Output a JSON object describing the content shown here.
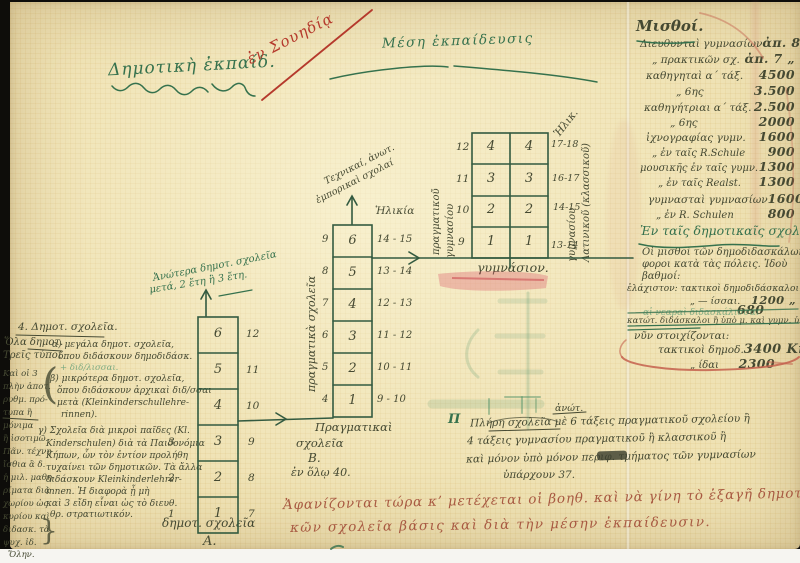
{
  "headers": {
    "primary": "Δημοτικὴ ἐκπαίδ.",
    "annotation_red": "ἐν Σουηδίᾳ",
    "secondary": "Μέση ἐκπαίδευσις"
  },
  "salary_list": {
    "title": "Μισθοί.",
    "rows": [
      {
        "label": "Διευθυνταὶ γυμνασίων",
        "value": "ἀπ. 8 χιλ. Κρ."
      },
      {
        "label": "„  πρακτικῶν σχ.",
        "value": "ἀπ. 7  „"
      },
      {
        "label": "καθηγηταὶ α΄ τάξ.",
        "value": "4500"
      },
      {
        "label": "„  6ης",
        "value": "3.500"
      },
      {
        "label": "καθηγήτριαι α΄ τάξ.",
        "value": "2.500"
      },
      {
        "label": "„  6ης",
        "value": "2000"
      },
      {
        "label": "ἰχνογραφίας γυμν.",
        "value": "1600"
      },
      {
        "label": "„  ἐν ταῖς R.Schule",
        "value": "900"
      },
      {
        "label": "μουσικῆς ἐν ταῖς γυμν.",
        "value": "1300"
      },
      {
        "label": "„  ἐν ταῖς Realst.",
        "value": "1300"
      },
      {
        "label": "γυμνασταὶ γυμνασίων",
        "value": "1600"
      },
      {
        "label": "„  ἐν R. Schulen",
        "value": "800"
      }
    ],
    "primary_section": {
      "title": "Ἐν ταῖς δημοτικαῖς σχολαῖς",
      "notes": [
        "Οἱ μισθοὶ τῶν δημοδιδασκάλων διά-",
        "φοροι κατὰ τὰς πόλεις. Ἰδοὺ",
        "βαθμοί:"
      ],
      "row_min": {
        "label": "ἐλάχιστον: τακτικοὶ δημοδιδάσκαλοι",
        "value": "1250 Kr."
      },
      "row_min2": {
        "label": "„  — ίσσαι.",
        "value": "1200 „"
      },
      "row_680": {
        "label": "αἱ νεαραὶ διδασκάλισσαι",
        "value": "680"
      },
      "row_struck": "κατώτ. διδάσκαλοι ἢ ὑπὸ μ. καὶ γυμν. ὑπηρ.",
      "row_now": "νῦν στοιχίζονται:",
      "row_3400": {
        "label": "τακτικοὶ δημοδ.",
        "value": "3400 Kr."
      },
      "row_2300": {
        "label": "„  ίδαι",
        "value": "2300"
      }
    }
  },
  "primary_ladder": {
    "note_line1": "Ἀνώτερα δημοτ. σχολεῖα",
    "note_line2": "μετά, 2 ἔτη ἢ 3 ἔτη.",
    "cells": [
      "6",
      "5",
      "4",
      "3",
      "2",
      "1"
    ],
    "right_numbers": [
      "12",
      "11",
      "10",
      "9",
      "8",
      "7"
    ],
    "left_numbers": [
      "3",
      "2",
      "1"
    ],
    "caption": "δημοτ. σχολεῖα",
    "caption2": "Α."
  },
  "real_ladder": {
    "top_note1": "Τεχνικαί, ἀνωτ.",
    "top_note2": "ἐμπορικαὶ σχολαί",
    "age_header": "Ἡλικία",
    "cells": [
      "6",
      "5",
      "4",
      "3",
      "2",
      "1"
    ],
    "left_numbers": [
      "9",
      "8",
      "7",
      "6",
      "5",
      "4"
    ],
    "ages": [
      "14 - 15",
      "13 - 14",
      "12 - 13",
      "11 - 12",
      "10 - 11",
      "9 - 10"
    ],
    "side_label": "πραγματικὰ σχολεῖα",
    "caption1": "Πραγματικαὶ",
    "caption2": "σχολεῖα",
    "caption3": "Β.",
    "caption4": "ἐν ὅλῳ 40."
  },
  "gymnasium": {
    "age_header": "Ἡλικ.",
    "row_labels": [
      "12",
      "11",
      "10",
      "9"
    ],
    "cells_left": [
      "4",
      "3",
      "2",
      "1"
    ],
    "cells_right": [
      "4",
      "3",
      "2",
      "1"
    ],
    "ages": [
      "17-18",
      "16-17",
      "14-15",
      "13-14"
    ],
    "left_label1": "πραγματικοῦ",
    "left_label2": "γυμνασίου",
    "right_label1": "γυμνασίου",
    "right_label2": "Λατινικοῦ (κλασσικοῦ)",
    "caption": "γυμνάσιον."
  },
  "full_note": {
    "mark": "Π",
    "super": "ἀνώτ.",
    "line1": "Πλήρη σχολεῖα μὲ 6 τάξεις πραγματικοῦ σχολείου ἢ",
    "line2": "4 τάξεις γυμνασίου πραγματικοῦ ἢ κλασσικοῦ ἢ",
    "line3": "καὶ μόνον ὑπὸ μόνον περιφ. τμήματος τῶν γυμνασίων",
    "line4": "ὑπάρχουν 37."
  },
  "bottom_note": {
    "line1": "Ἀφανίζονται τώρα κ’ μετέχεται οἱ βοηθ. καὶ νὰ γίνη τὸ ἑξαγῆ δημοτι —",
    "line2": "κῶν σχολεῖα βάσις καὶ διὰ τὴν μέσην ἐκπαίδευσιν."
  },
  "margin": {
    "heading": "4. Δημοτ. σχολεῖα.",
    "sub1": "Ὅλα δημοτ.",
    "sub2": "Τρεῖς τύποι",
    "item_a": [
      "α) μεγάλα δημοτ. σχολεῖα,",
      "ὅπου διδάσκουν δημοδιδάσκ.",
      "+ διδ/λισσαι."
    ],
    "item_b": [
      "β) μικρότερα δημοτ. σχολεῖα,",
      "ὅπου διδάσκουν ἀρχικαὶ διδ/σσαι",
      "μετὰ (Kleinkinderschullehre-",
      "rinnen)."
    ],
    "item_c": [
      "γ) Σχολεῖα διὰ μικροὶ παῖδες (Kl.",
      "Kinderschulen) διὰ τὰ Παιδονόμια",
      "Κήπων, ὧν τὸν ἐντίον προλήθη",
      "τυχαίνει τῶν δημοτικῶν. Τὰ ἄλλα",
      "διδάσκουν Kleinkinderlehrer-",
      "innen. Ἡ διαφορὰ ᾗ μὴ",
      "καὶ 3 εἴδη εἶναι ὡς τὸ διευθ.",
      "θρ. στρατιωτικόν."
    ],
    "side": [
      "Καὶ οἱ 3",
      "πλὴν ἀποτ.",
      "ρυθμ. πρό-",
      "τυπα ἢ",
      "μόνιμα",
      "ἢ ἰσοτιμῶ.",
      "Πᾶν. τέχνη",
      "ἴσθια ἃ δ.",
      "ἡ μιλ. μαθη-",
      "ρίματα διὰ",
      "χωρίου ὡς",
      "κυρίου καὶ",
      "διδασκ. τὰ",
      "ψυχ. ἰδ.",
      "Ὅλην."
    ],
    "brace_open": "(",
    "brace_close": "}"
  }
}
